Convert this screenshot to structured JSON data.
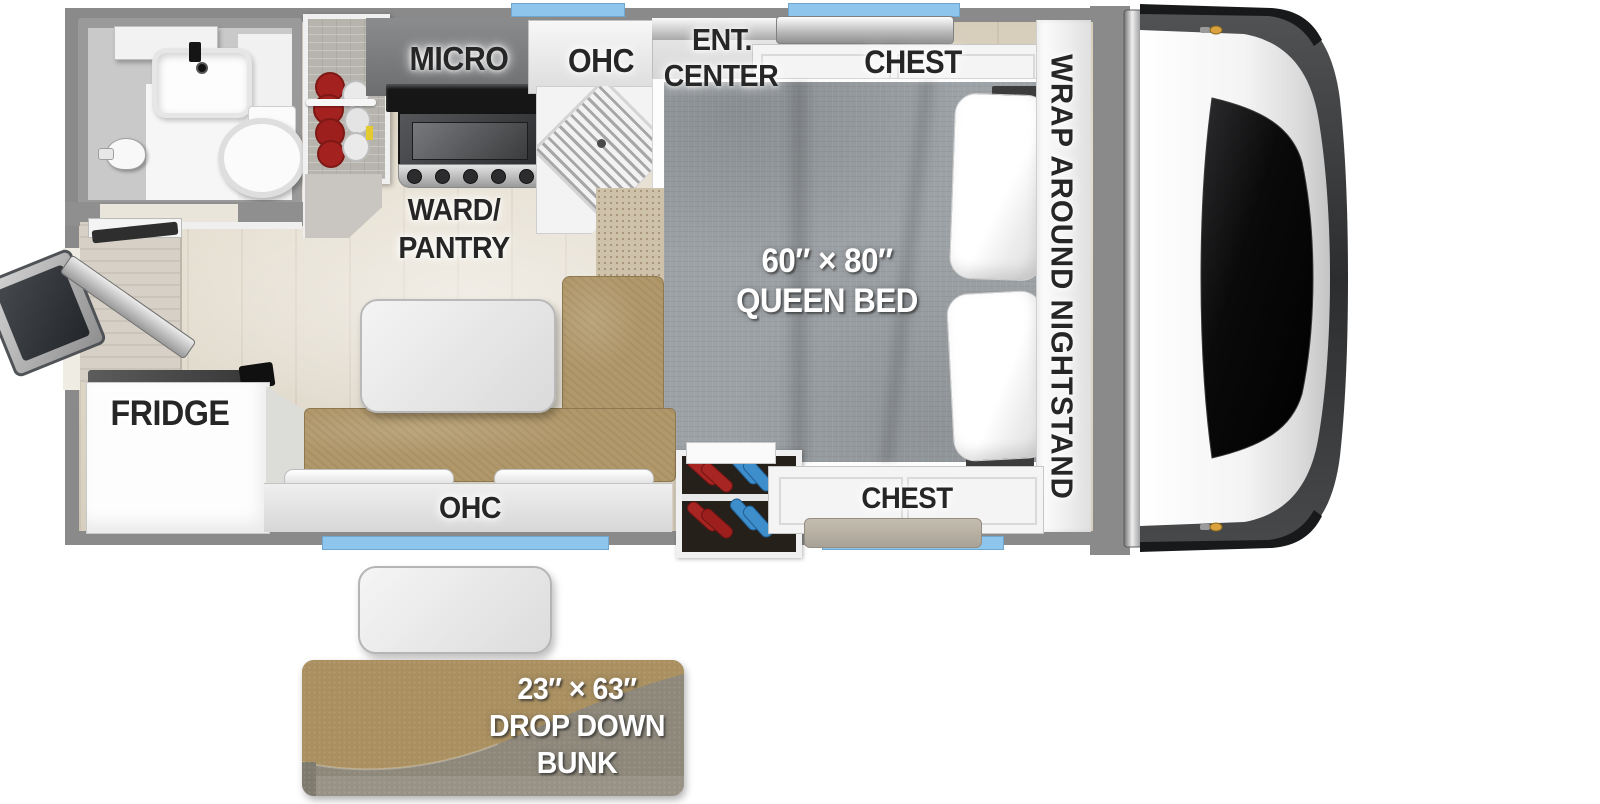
{
  "labels": {
    "micro": "MICRO",
    "ohc_top": "OHC",
    "ent_line1": "ENT.",
    "ent_line2": "CENTER",
    "chest_top": "CHEST",
    "nightstand": "WRAP AROUND NIGHTSTAND",
    "bed_line1": "60″ × 80″",
    "bed_line2": "QUEEN BED",
    "ward_line1": "WARD/",
    "ward_line2": "PANTRY",
    "fridge": "FRIDGE",
    "ohc_bottom": "OHC",
    "chest_bottom": "CHEST",
    "bunk_line1": "23″ × 63″",
    "bunk_line2": "DROP DOWN",
    "bunk_line3": "BUNK"
  },
  "colors": {
    "wall": "#8a8a8a",
    "floor": "#e2dac9",
    "window_blue": "#8ec5ec",
    "bench_tan": "#b1986a",
    "bed_gray": "#9da2a6",
    "carpet": "#cfc2aa",
    "bunk_tan": "#aa9060",
    "bunk_gray": "#8e887b",
    "shoe_red": "#a72522",
    "shoe_blue": "#3e8ecb",
    "clearance_amber": "#dba13f"
  }
}
